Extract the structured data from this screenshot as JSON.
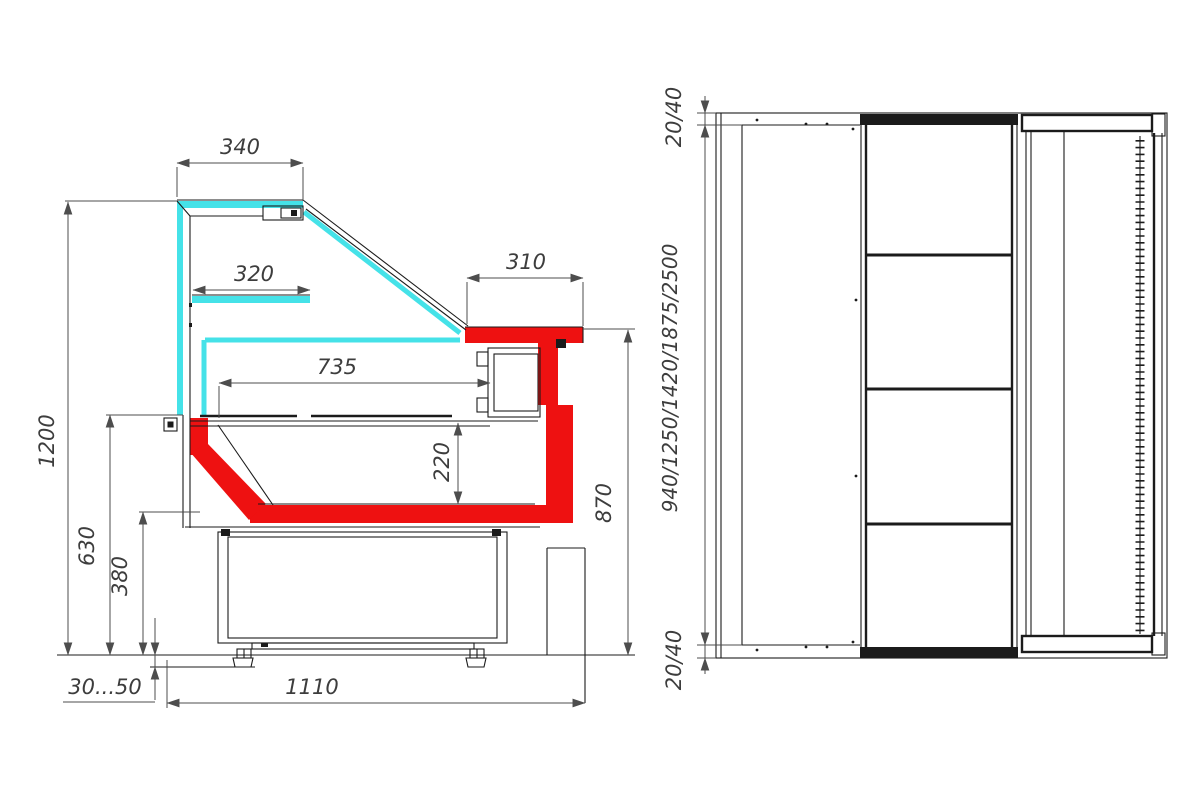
{
  "drawing": {
    "title": "refrigerated-display-case-dimension-drawing",
    "colors": {
      "bg": "#ffffff",
      "line": "#1b1b1b",
      "dim": "#4d4d4d",
      "text": "#3d3d3d",
      "red": "#ee1111",
      "cyan": "#45e2e8"
    },
    "side_view": {
      "label": "side section view",
      "dims": {
        "d340": "340",
        "d320": "320",
        "d310": "310",
        "d735": "735",
        "d220": "220",
        "d1200": "1200",
        "d630": "630",
        "d380": "380",
        "d3050": "30...50",
        "d1110": "1110",
        "d870": "870"
      }
    },
    "plan_view": {
      "label": "top plan view",
      "dims": {
        "top": "20/40",
        "lengths": "940/1250/1420/1875/2500",
        "bottom": "20/40"
      }
    }
  }
}
